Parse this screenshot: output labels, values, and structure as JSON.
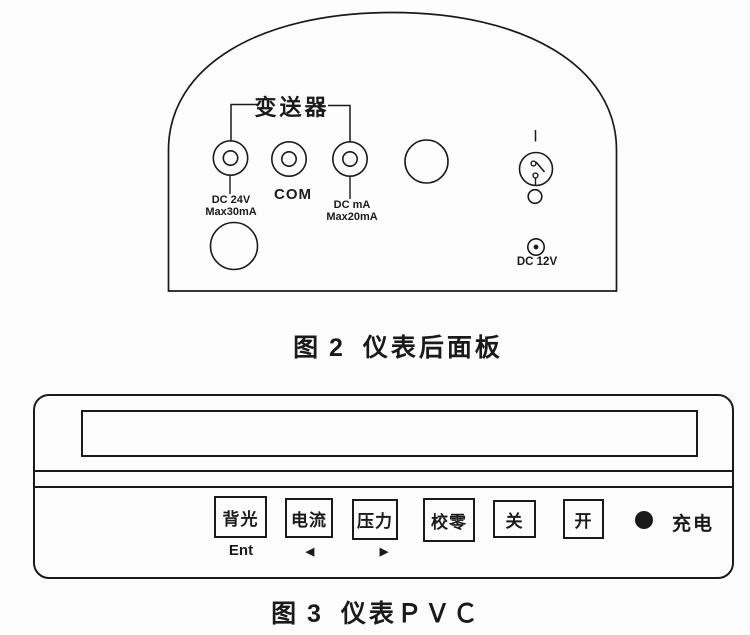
{
  "colors": {
    "ink": "#1a1a1a",
    "paper": "#fdfdfd"
  },
  "figure2": {
    "transmitter_label": "变送器",
    "jack_24v": {
      "line1": "DC 24V",
      "line2": "Max30mA"
    },
    "jack_com": {
      "label": "COM"
    },
    "jack_ma": {
      "line1": "DC mA",
      "line2": "Max20mA"
    },
    "dc12v_label": "DC 12V",
    "caption_prefix": "图 2",
    "caption_title": "仪表后面板"
  },
  "figure3": {
    "buttons": [
      {
        "label": "背光",
        "sub": "Ent"
      },
      {
        "label": "电流",
        "sub": "◀"
      },
      {
        "label": "压力",
        "sub": "▶"
      },
      {
        "label": "校零",
        "sub": ""
      },
      {
        "label": "关",
        "sub": ""
      },
      {
        "label": "开",
        "sub": ""
      }
    ],
    "charge_label": "充电",
    "caption_prefix": "图 3",
    "caption_title": "仪表ＰＶＣ"
  }
}
